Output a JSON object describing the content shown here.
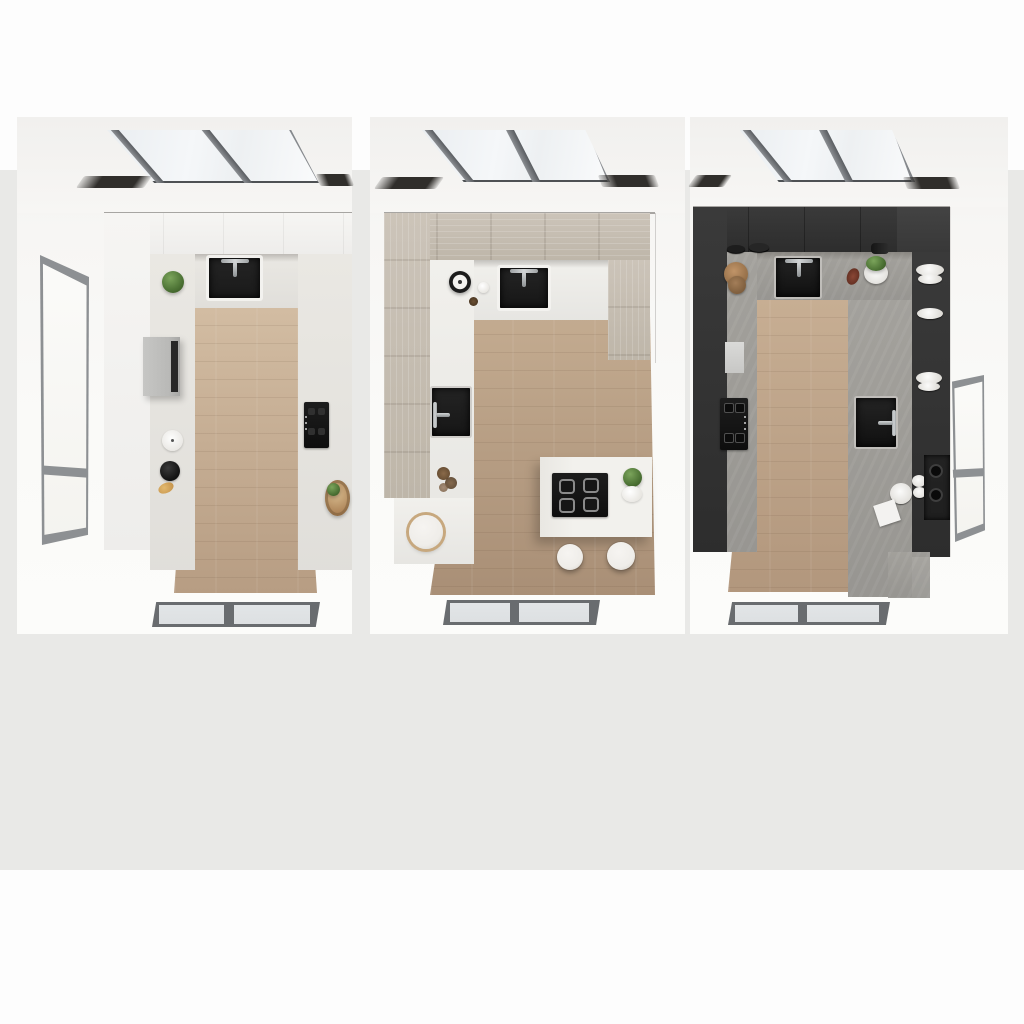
{
  "scene": {
    "type": "3d-render",
    "description": "Three overhead top-down renders of the same U-shaped kitchen with a slanted skylight, shown in three finishes: glossy white, light oak, and graphite.",
    "panel_count": 3,
    "background": "#fdfdfd",
    "backdrop": "#e9e9e7"
  },
  "shared": {
    "pagebg": "#fdfdfd",
    "ceiling": "#f4f3f1",
    "skylight_frame": "#6a6d71",
    "skylight_glass": "#eff2f5",
    "faucet_metal": "#d2d5d6",
    "window_frame": "#8d9093",
    "window_glass": "#fbfbf9",
    "floor_window_frame": "#696c6f",
    "floor_window_glass": "#dde0e2",
    "plant_green": "#4e7436",
    "stool_white": "#efede9",
    "wood_accent": "#ab8155"
  },
  "panels": [
    {
      "id": "white-kitchen",
      "title": "White kitchen - top view",
      "palette": {
        "cab": "#f6f5f3",
        "cab2": "#eeedeb",
        "counter": "#eae8e3",
        "floor1": "#d2bca2",
        "floor2": "#b79d83",
        "sink": "#1a1a1a",
        "accent": "#b9b9b7"
      },
      "items": [
        "skylight",
        "ceiling-recesses",
        "left-wall-window",
        "black-sink",
        "chrome-faucet",
        "green-plant",
        "steel-wall-box",
        "paper-roll",
        "black-bowl",
        "pastry",
        "built-in-cooktop",
        "storage-basket",
        "wood-floor",
        "floor-window"
      ]
    },
    {
      "id": "light-oak-kitchen",
      "title": "Light oak kitchen - top view",
      "palette": {
        "cab": "#ccc4b9",
        "cab2": "#beb6a9",
        "counter": "#f1f0ec",
        "floor1": "#c3ab90",
        "floor2": "#a98f76",
        "sink": "#161616",
        "accent": "#f2f1ed"
      },
      "items": [
        "skylight",
        "ceiling-recesses",
        "black-sink",
        "chrome-faucet",
        "kitchen-timer",
        "prep-sink",
        "dried-flowers",
        "round-stool",
        "kitchen-island",
        "island-cooktop",
        "island-plant",
        "white-bowl",
        "bar-stools",
        "wood-floor",
        "floor-window"
      ],
      "bar_stool_count": 2
    },
    {
      "id": "graphite-kitchen",
      "title": "Graphite kitchen - top view",
      "palette": {
        "cab": "#3a3a3a",
        "cab2": "#2d2d2d",
        "counter": "#a3a19c",
        "floor1": "#c7ae93",
        "floor2": "#b2977d",
        "sink": "#101010",
        "accent": "#1f1f1f"
      },
      "items": [
        "skylight",
        "ceiling-recesses",
        "black-sink",
        "chrome-faucet",
        "stacked-plates",
        "cutting-boards",
        "potted-plant",
        "dark-bottles",
        "built-in-cooktop",
        "white-appliance-panel",
        "prep-sink",
        "dish-shelves",
        "wine-rack",
        "serving-plate",
        "butter-dish",
        "counter-step",
        "right-wall-window",
        "wood-floor",
        "floor-window"
      ]
    }
  ]
}
